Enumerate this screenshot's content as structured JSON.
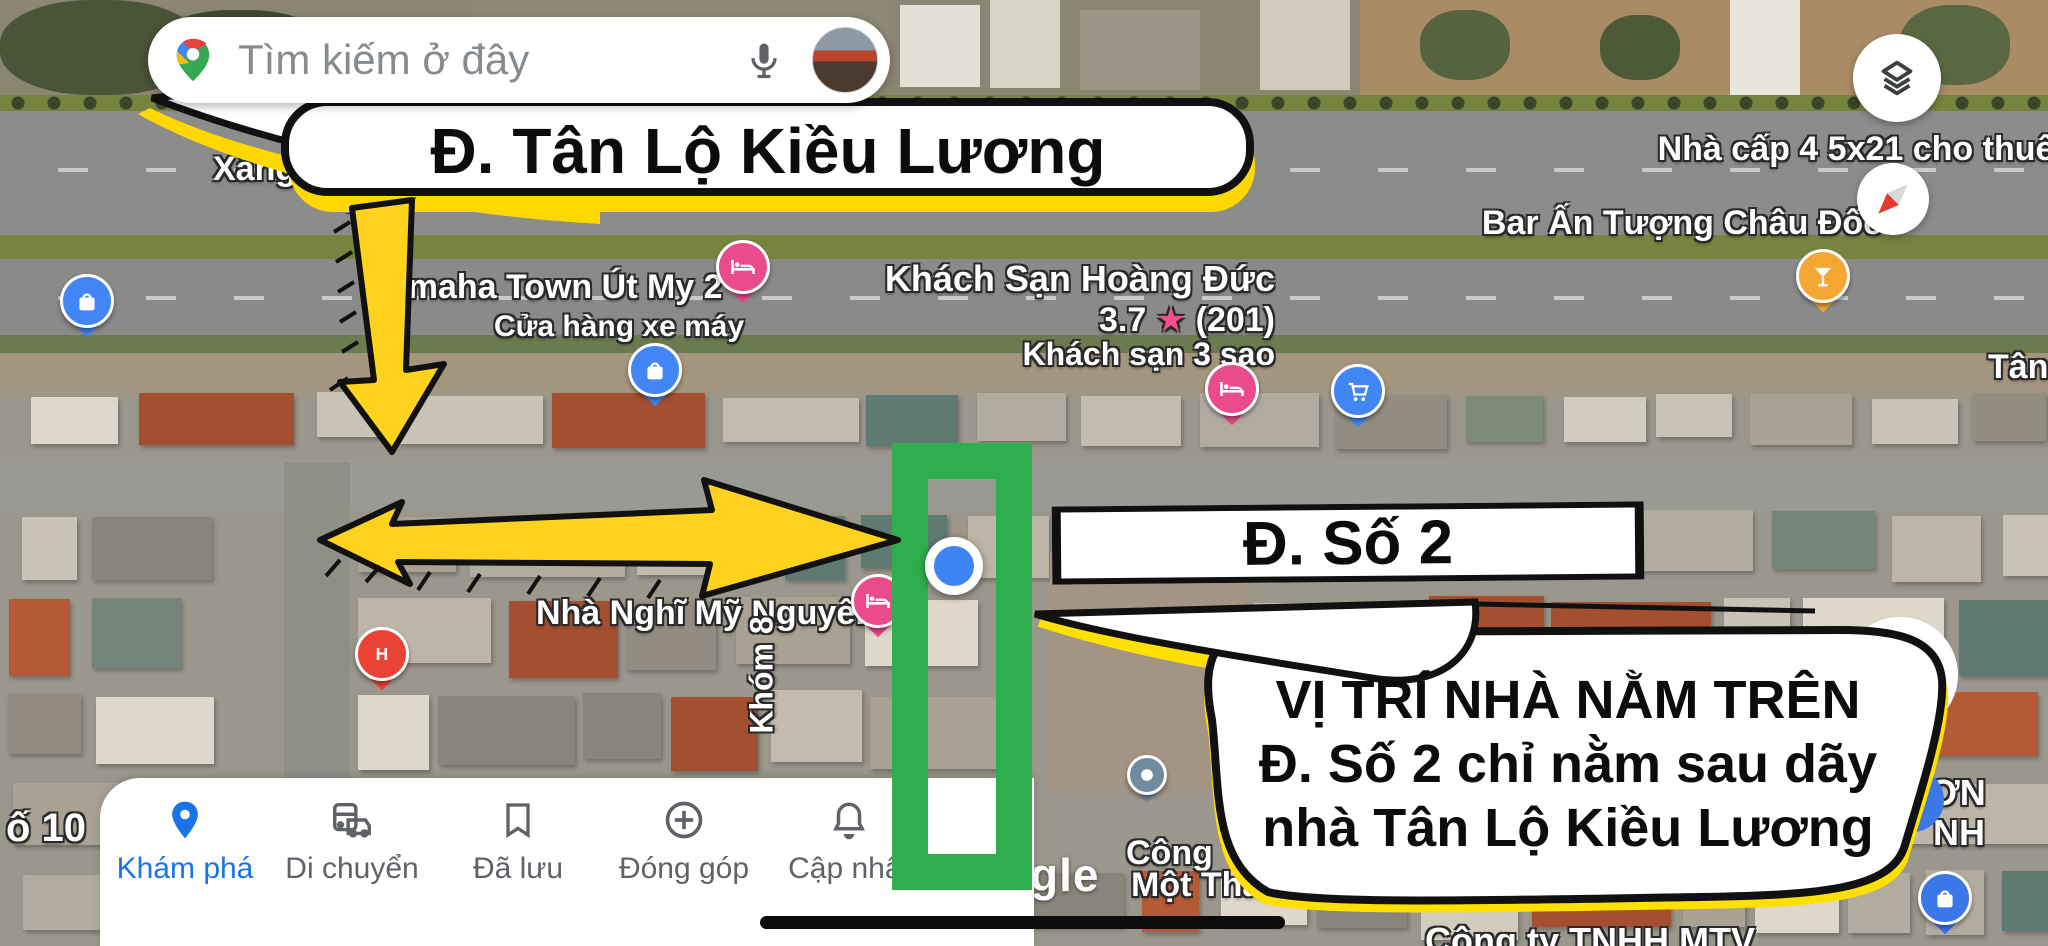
{
  "search": {
    "placeholder": "Tìm kiếm ở đây"
  },
  "annotations": {
    "street_top": "Đ. Tân Lộ Kiều Lương",
    "street_2": "Đ. Số 2",
    "callout_line1": "VỊ TRÍ NHÀ NẰM TRÊN",
    "callout_line2": "Đ. Số 2 chỉ nằm sau dãy",
    "callout_line3": "nhà Tân Lộ Kiều Lương"
  },
  "map_labels": {
    "xang_dau": "Xăng Dầu Ph",
    "yamaha": "Yamaha Town Út My 2",
    "yamaha_sub": "Cửa hàng xe máy",
    "hotel_name": "Khách Sạn Hoàng Đức",
    "hotel_rating": "3.7",
    "hotel_star": "★",
    "hotel_reviews": "(201)",
    "hotel_type": "Khách sạn 3 sao",
    "nha_cap": "Nhà cấp 4 5x21 cho thuê",
    "bar": "Bar Ấn Tượng Châu Đốc",
    "tan_l": "Tân L",
    "nha_nghi": "Nhà Nghĩ Mỹ Nguyên",
    "khom8": "Khóm 8",
    "o10": "ố 10",
    "nha_frag": "Nhà",
    "pha_frag": "Phá",
    "cong_t": "Công T",
    "mot_tha": "Một Tha",
    "cong_ty_mtv": "Công ty TNHH MTV",
    "on_frag": "ƠN",
    "nh_frag": "NH",
    "watermark": "Google"
  },
  "nav": {
    "items": [
      {
        "label": "Khám phá",
        "icon": "explore-pin-icon",
        "active": true
      },
      {
        "label": "Di chuyển",
        "icon": "commute-icon",
        "active": false
      },
      {
        "label": "Đã lưu",
        "icon": "bookmark-icon",
        "active": false
      },
      {
        "label": "Đóng góp",
        "icon": "add-circle-icon",
        "active": false
      },
      {
        "label": "Cập nhật",
        "icon": "bell-icon",
        "active": false
      }
    ]
  },
  "pins": [
    {
      "name": "shopping-bag-pin",
      "glyph": "bag",
      "color": "#4285f4",
      "x": 87,
      "y": 307
    },
    {
      "name": "hotel-bed-pin",
      "glyph": "bed",
      "color": "#ea4b8b",
      "x": 743,
      "y": 273
    },
    {
      "name": "shopping-bag-pin",
      "glyph": "bag",
      "color": "#4285f4",
      "x": 655,
      "y": 376
    },
    {
      "name": "hotel-bed-pin",
      "glyph": "bed",
      "color": "#ea4b8b",
      "x": 1232,
      "y": 395
    },
    {
      "name": "shopping-cart-pin",
      "glyph": "cart",
      "color": "#4285f4",
      "x": 1358,
      "y": 397
    },
    {
      "name": "bar-cocktail-pin",
      "glyph": "cocktail",
      "color": "#f4a732",
      "x": 1823,
      "y": 282
    },
    {
      "name": "hotel-bed-pin",
      "glyph": "bed",
      "color": "#ea4b8b",
      "x": 878,
      "y": 607
    },
    {
      "name": "hospital-h-pin",
      "glyph": "H",
      "color": "#ea4335",
      "x": 382,
      "y": 660
    },
    {
      "name": "generic-poi-pin",
      "glyph": "dot",
      "color": "#718b9e",
      "x": 1147,
      "y": 780,
      "mini": true
    },
    {
      "name": "generic-poi-pin",
      "glyph": "dot",
      "color": "#718b9e",
      "x": 1448,
      "y": 640,
      "mini": true
    },
    {
      "name": "shopping-bag-pin",
      "glyph": "bag",
      "color": "#3b78e7",
      "x": 1945,
      "y": 904
    }
  ],
  "colors": {
    "highlight_green": "#2eae4d",
    "annotation_yellow": "#ffd800",
    "active_blue": "#1a73e8",
    "location_dot": "#3f84f4",
    "rating_star_pink": "#f0508e"
  }
}
